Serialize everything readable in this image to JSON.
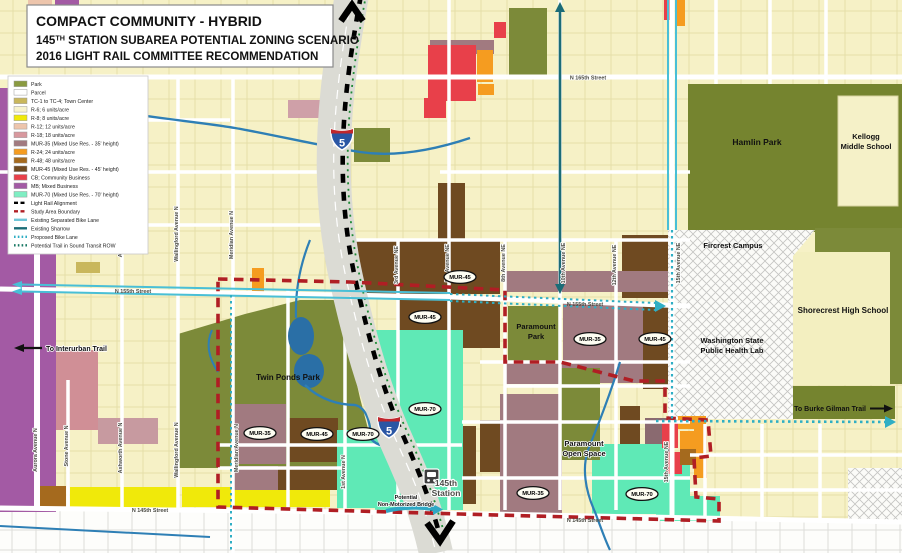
{
  "title": {
    "line1": "COMPACT COMMUNITY - HYBRID",
    "line2_num": "145",
    "line2_sup": "TH",
    "line2_rest": " STATION SUBAREA POTENTIAL ZONING SCENARIO",
    "line3": "2016 LIGHT RAIL COMMITTEE RECOMMENDATION"
  },
  "legend": {
    "items": [
      {
        "label": "Park",
        "color": "#8A9A40",
        "kind": "fill"
      },
      {
        "label": "Parcel",
        "color": "#FFFFFF",
        "kind": "fill"
      },
      {
        "label": "TC-1 to TC-4; Town Center",
        "color": "#C9B75C",
        "kind": "fill"
      },
      {
        "label": "R-6; 6 units/acre",
        "color": "#F7F3CE",
        "kind": "fill"
      },
      {
        "label": "R-8; 8 units/acre",
        "color": "#F0E90A",
        "kind": "fill"
      },
      {
        "label": "R-12; 12 units/acre",
        "color": "#EDC5AC",
        "kind": "fill"
      },
      {
        "label": "R-18; 18 units/acre",
        "color": "#D8989E",
        "kind": "fill"
      },
      {
        "label": "MUR-35 (Mixed Use Res. - 35' height)",
        "color": "#A17A80",
        "kind": "fill"
      },
      {
        "label": "R-24; 24 units/acre",
        "color": "#F59C20",
        "kind": "fill"
      },
      {
        "label": "R-48; 48 units/acre",
        "color": "#A56A1E",
        "kind": "fill"
      },
      {
        "label": "MUR-45 (Mixed Use Res. - 45' height)",
        "color": "#6F4A21",
        "kind": "fill"
      },
      {
        "label": "CB; Community Business",
        "color": "#E8404A",
        "kind": "fill"
      },
      {
        "label": "MB; Mixed Business",
        "color": "#A35AA4",
        "kind": "fill"
      },
      {
        "label": "MUR-70 (Mixed Use Res. - 70' height)",
        "color": "#7FEEC3",
        "kind": "fill"
      },
      {
        "label": "Light Rail Alignment",
        "color": "#000000",
        "kind": "dash"
      },
      {
        "label": "Study Area Boundary",
        "color": "#B01E24",
        "kind": "dash"
      },
      {
        "label": "Existing Separated Bike Lane",
        "color": "#6FC6D8",
        "kind": "solid"
      },
      {
        "label": "Existing Sharrow",
        "color": "#1B6C77",
        "kind": "solid"
      },
      {
        "label": "Proposed Bike Lane",
        "color": "#2FAEC4",
        "kind": "dot"
      },
      {
        "label": "Potential Trail in Sound Transit ROW",
        "color": "#1B7A66",
        "kind": "dot"
      }
    ]
  },
  "map": {
    "street_labels": [
      {
        "text": "Aurora Avenue N"
      },
      {
        "text": "Stone Avenue N"
      },
      {
        "text": "Ashworth Avenue N"
      },
      {
        "text": "Ashworth Avenue N"
      },
      {
        "text": "Wallingford Avenue N"
      },
      {
        "text": "Wallingford Avenue N"
      },
      {
        "text": "Meridian Avenue N"
      },
      {
        "text": "Meridian Avenue N"
      },
      {
        "text": "1st Avenue N"
      },
      {
        "text": "3rd Avenue NE"
      },
      {
        "text": "5th Avenue NE"
      },
      {
        "text": "8th Avenue NE"
      },
      {
        "text": "10th Avenue NE"
      },
      {
        "text": "12th Avenue NE"
      },
      {
        "text": "15th Avenue NE"
      },
      {
        "text": "15th Avenue NE"
      },
      {
        "text": "N 165th Street"
      },
      {
        "text": "N 155th Street"
      },
      {
        "text": "N 155th Street"
      },
      {
        "text": "N 145th Street"
      },
      {
        "text": "N 145th Street"
      }
    ],
    "badges": [
      {
        "text": "MUR-45"
      },
      {
        "text": "MUR-45"
      },
      {
        "text": "MUR-35"
      },
      {
        "text": "MUR-45"
      },
      {
        "text": "MUR-35"
      },
      {
        "text": "MUR-45"
      },
      {
        "text": "MUR-70"
      },
      {
        "text": "MUR-70"
      },
      {
        "text": "MUR-35"
      },
      {
        "text": "MUR-70"
      }
    ],
    "places": {
      "twin_ponds": "Twin Ponds Park",
      "paramount_park_1": "Paramount",
      "paramount_park_2": "Park",
      "paramount_open_1": "Paramount",
      "paramount_open_2": "Open Space",
      "hamlin": "Hamlin Park",
      "kellogg_1": "Kellogg",
      "kellogg_2": "Middle School",
      "fircrest": "Fircrest Campus",
      "health_lab_1": "Washington State",
      "health_lab_2": "Public Health Lab",
      "shorecrest": "Shorecrest High School"
    },
    "annotations": {
      "interurban": "To Interurban Trail",
      "burke": "To Burke Gilman Trail",
      "station_1": "145th",
      "station_2": "Station",
      "bridge_1": "Potential",
      "bridge_2": "Non-Motorized Bridge"
    },
    "shield_label": "5"
  }
}
